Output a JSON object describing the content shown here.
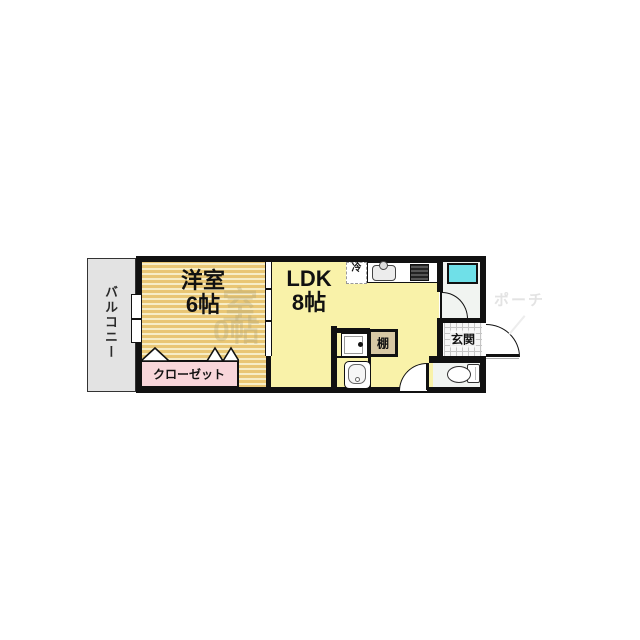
{
  "plan": {
    "balcony_label": "バルコニー",
    "western_room_name": "洋室",
    "western_room_size": "6帖",
    "ldk_name": "LDK",
    "ldk_size": "8帖",
    "closet_label": "クローゼット",
    "entrance_label": "玄関",
    "shelf_label": "棚",
    "fridge_label": "冷"
  },
  "watermarks": {
    "porch": "ポーチ",
    "ghost_room": "室",
    "ghost_size": "0帖"
  },
  "colors": {
    "wall": "#111111",
    "ldk-floor": "#f9f2a9",
    "tatami-stripe-dark": "#e9c674",
    "tatami-stripe-light": "#f7edc6",
    "closet-pink": "#f8d6da",
    "balcony-gray": "#e3e3e3",
    "bath-cyan": "#6fe0e8",
    "shelf-tan": "#d8c8a4",
    "bath-floor": "#f1f4f1",
    "tile-line": "#c4c4c4"
  }
}
